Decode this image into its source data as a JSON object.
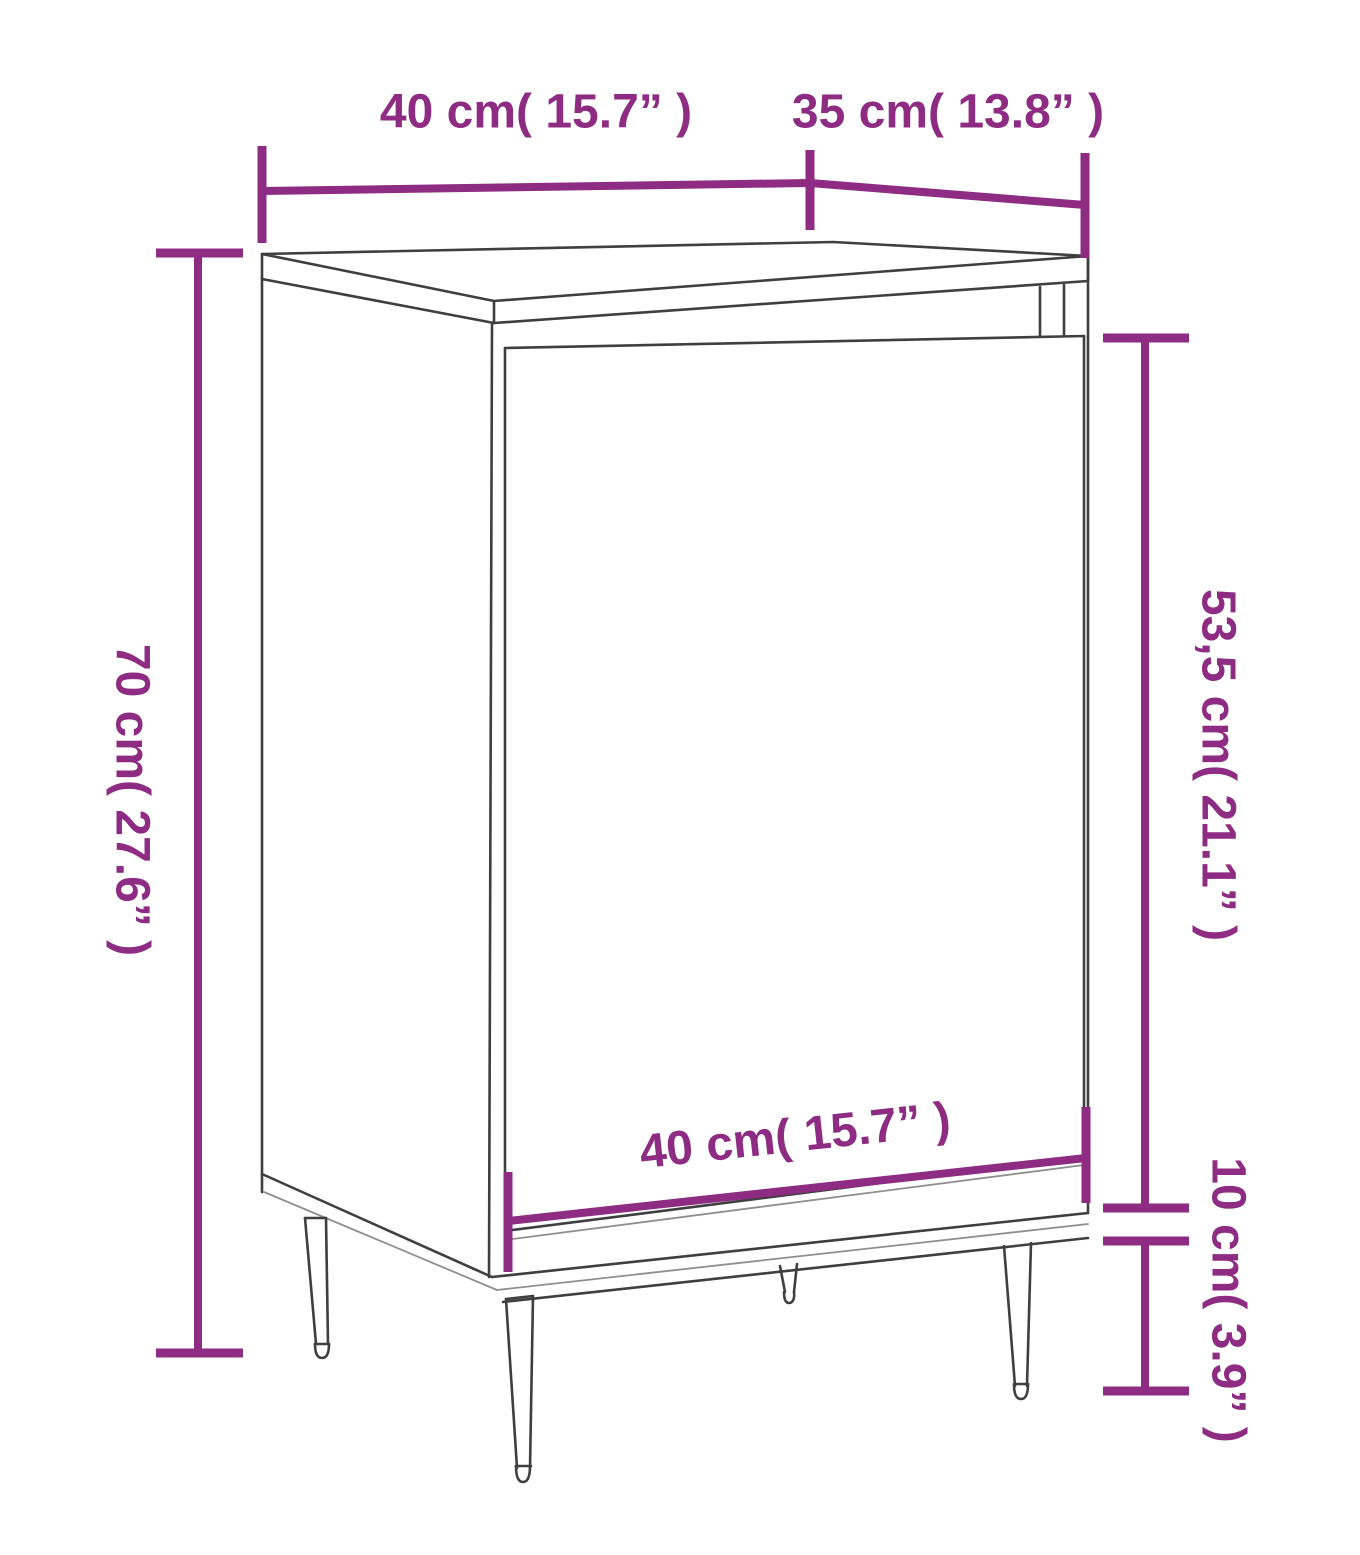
{
  "colors": {
    "accent": "#8e2b82",
    "line": "#3f3f3f",
    "line_light": "#8f8f8f",
    "background": "#ffffff"
  },
  "figure": {
    "type": "furniture-dimension-diagram",
    "subject": "cabinet with door and four tapered legs"
  },
  "labels": {
    "top_width": "40 cm( 15.7” )",
    "top_depth": "35 cm( 13.8” )",
    "left_height": "70 cm( 27.6” )",
    "door_height": "53,5 cm( 21.1” )",
    "bottom_width": "40 cm( 15.7” )",
    "leg_height": "10 cm( 3.9” )"
  }
}
